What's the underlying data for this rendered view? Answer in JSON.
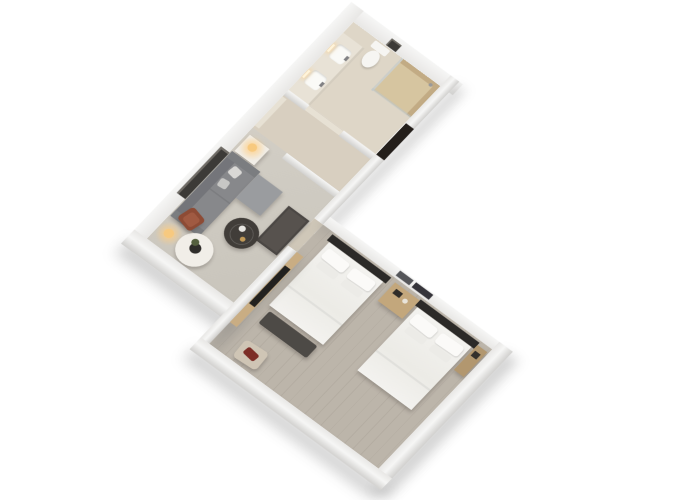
{
  "scene": {
    "view": "3d-isometric-floor-plan-render",
    "rooms": [
      {
        "name": "bathroom",
        "furniture": [
          "walk-in-shower",
          "shower-glass-partition",
          "shower-head",
          "toilet",
          "double-sink-vanity",
          "vanity-faucets",
          "mirror-light-strips",
          "wall-art"
        ]
      },
      {
        "name": "entry-hall",
        "furniture": [
          "entry-door",
          "closet-panel",
          "sliding-door"
        ]
      },
      {
        "name": "living-room",
        "furniture": [
          "sectional-sofa",
          "sofa-chaise",
          "throw-pillows",
          "wall-art",
          "side-table",
          "table-lamp",
          "floor-lamp",
          "round-coffee-table",
          "coffee-table-tray",
          "round-white-table",
          "plant-vase",
          "rust-accent-chair",
          "console-desk"
        ]
      },
      {
        "name": "bedroom",
        "furniture": [
          "double-bed-west",
          "double-bed-east",
          "dark-headboards",
          "white-duvets",
          "pillows",
          "nightstand",
          "nightstand-accessories",
          "wall-frame-silver",
          "wall-frame-dark",
          "foot-bench",
          "tv-wood-panel",
          "tv-screen",
          "luggage-console",
          "armchair",
          "red-accent-pillow"
        ]
      }
    ]
  },
  "colors": {
    "background": "#ffffff",
    "wall_light": "#f6f6f5",
    "wall_mid": "#e8e7e5",
    "wall_dark": "#d1d0ce",
    "wall_shadow": "rgba(115,115,115,0.32)",
    "floor_bathroom": "#ded6c7",
    "floor_corridor": "#d8cfc0",
    "floor_living": "#d2cec5",
    "floor_passage": "#cfc7b8",
    "floor_bedroom": "#bcb5aa",
    "shower_stone": "#d6c5a0",
    "shower_stone_dark": "#c2ab84",
    "shower_glass": "rgba(185,198,204,0.5)",
    "fixture_white": "#f6f5f2",
    "vanity_counter": "#e8e2d6",
    "warm_light": "#f7c97f",
    "warm_glow": "rgba(255,205,130,0.55)",
    "sofa": "#87888b",
    "sofa_dark": "#74757a",
    "sofa_light": "#9a9c9f",
    "pillow_light": "#d9d8d5",
    "table_dark": "#413d39",
    "table_white": "#f1eee8",
    "chair_rust": "#8d4b35",
    "chair_rust_seat": "#a05a42",
    "desk_dark": "#4b4744",
    "wood_light": "#c9ad83",
    "wood_mid": "#c3a77c",
    "wood_deep": "#b2976f",
    "tv_screen": "#22211f",
    "headboard": "#2c2a28",
    "bedding": "#f3f2ef",
    "bench_dark": "#4d4a46",
    "armchair_beige": "#cfc5b5",
    "pillow_red": "#7c2d26",
    "door_dark": "#241f1b",
    "door_leaf": "#e7e1d4",
    "art_dark": "#3c3a37",
    "frame_silver": "#55565a",
    "frame_dark": "#35343a"
  }
}
